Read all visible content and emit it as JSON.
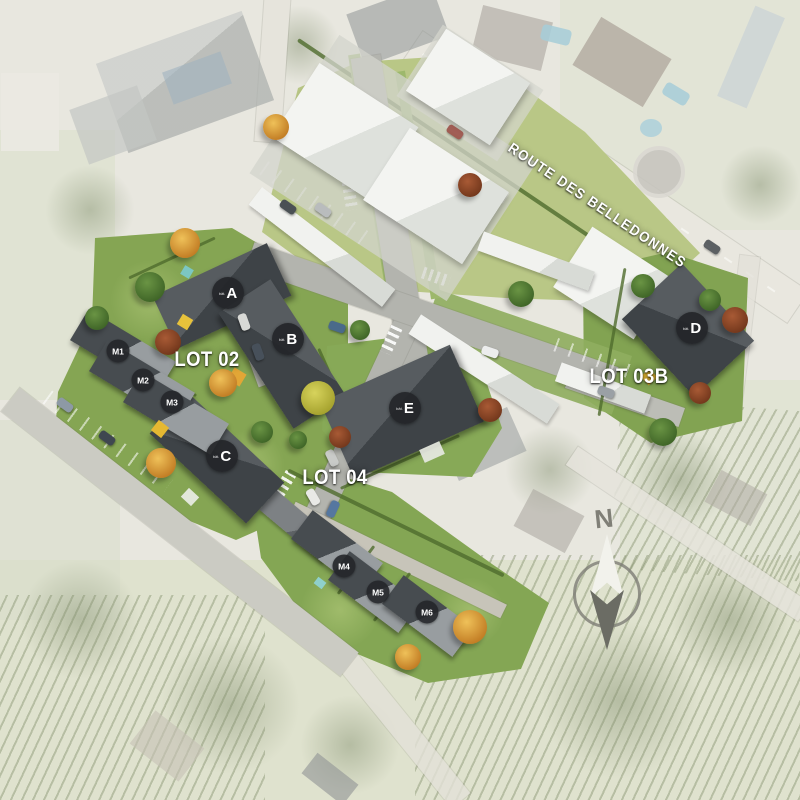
{
  "site": {
    "street_name": "ROUTE DES BELLEDONNES",
    "north_label": "N",
    "lots": [
      {
        "id": "lot-02",
        "label": "LOT 02"
      },
      {
        "id": "lot-03b",
        "label": "LOT 03B"
      },
      {
        "id": "lot-04",
        "label": "LOT 04"
      }
    ],
    "buildings": [
      {
        "id": "a",
        "prefix": "bât.",
        "letter": "A"
      },
      {
        "id": "b",
        "prefix": "bât.",
        "letter": "B"
      },
      {
        "id": "c",
        "prefix": "bât.",
        "letter": "C"
      },
      {
        "id": "d",
        "prefix": "bât.",
        "letter": "D"
      },
      {
        "id": "e",
        "prefix": "bât.",
        "letter": "E"
      }
    ],
    "houses": [
      {
        "id": "m1",
        "label": "M1"
      },
      {
        "id": "m2",
        "label": "M2"
      },
      {
        "id": "m3",
        "label": "M3"
      },
      {
        "id": "m4",
        "label": "M4"
      },
      {
        "id": "m5",
        "label": "M5"
      },
      {
        "id": "m6",
        "label": "M6"
      }
    ],
    "colors": {
      "lawn": "#85a553",
      "lawn_light": "#9fbb70",
      "roof_dark": "#3e4347",
      "roof_light": "#989da0",
      "road": "#b3b4ae",
      "white_building": "#f3f4f1",
      "tree_green": "#4f7d35",
      "tree_orange": "#dd9a33",
      "tree_red": "#96492c",
      "tree_yellow": "#c9c53f",
      "marker_bg": "#262829",
      "marker_text": "#ffffff"
    }
  }
}
